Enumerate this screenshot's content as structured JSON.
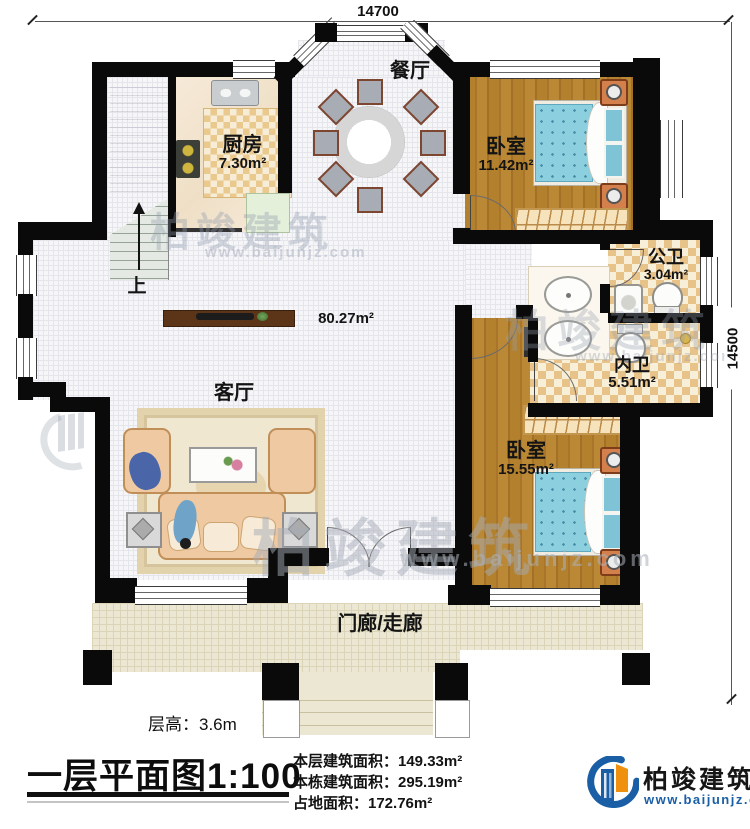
{
  "dimensions": {
    "top": "14700",
    "right": "14500"
  },
  "rooms": {
    "dining": {
      "name": "餐厅"
    },
    "kitchen": {
      "name": "厨房",
      "area": "7.30m²"
    },
    "bedroom1": {
      "name": "卧室",
      "area": "11.42m²"
    },
    "public_bath": {
      "name": "公卫",
      "area": "3.04m²"
    },
    "ensuite_bath": {
      "name": "内卫",
      "area": "5.51m²"
    },
    "bedroom2": {
      "name": "卧室",
      "area": "15.55m²"
    },
    "living": {
      "name": "客厅"
    },
    "hall": {
      "area": "80.27m²"
    },
    "porch": {
      "name": "门廊/走廊"
    },
    "stairs": {
      "up_label": "上"
    }
  },
  "annotations": {
    "floor_height": "层高：3.6m",
    "title": "一层平面图",
    "scale": "1:100",
    "area_lines": [
      "本层建筑面积：149.33m²",
      "本栋建筑面积：295.19m²",
      "占地面积：172.76m²"
    ]
  },
  "logo": {
    "name": "柏竣建筑",
    "url": "www.baijunjz.com"
  },
  "watermark": {
    "name": "柏竣建筑",
    "url": "www.baijunjz.com"
  },
  "colors": {
    "wall": "#0a0a0a",
    "wood": "#b3802e",
    "checker_tan": "#e7c289",
    "porch": "#ece7d2",
    "mattress_blue": "#8ccfdf",
    "logo_blue": "#1a5ea6",
    "logo_orange": "#f0900f"
  }
}
